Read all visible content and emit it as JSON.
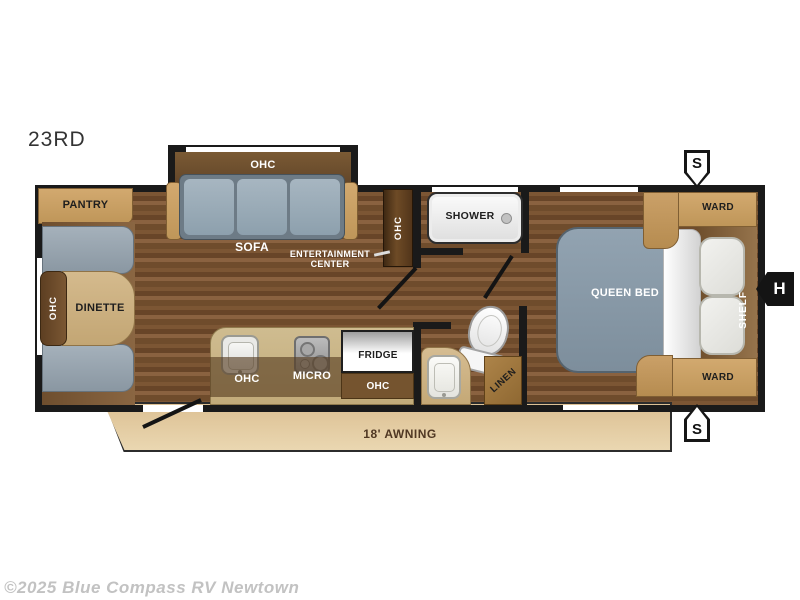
{
  "model_code": "23RD",
  "copyright": "©2025 Blue Compass RV Newtown",
  "awning_label": "18' AWNING",
  "badges": {
    "speaker_top": "S",
    "speaker_bottom": "S",
    "hitch": "H"
  },
  "living": {
    "pantry": "PANTRY",
    "dinette": "DINETTE",
    "dinette_ohc": "OHC",
    "sofa": "SOFA",
    "sofa_ohc": "OHC",
    "entertainment_line1": "ENTERTAINMENT",
    "entertainment_line2": "CENTER",
    "entertainment_ohc": "OHC"
  },
  "kitchen": {
    "ohc": "OHC",
    "micro": "MICRO",
    "fridge": "FRIDGE",
    "fridge_ohc": "OHC"
  },
  "bath": {
    "shower": "SHOWER",
    "linen": "LINEN"
  },
  "bedroom": {
    "bed": "QUEEN BED",
    "ward_top": "WARD",
    "ward_bottom": "WARD",
    "shelf": "SHELF"
  }
}
